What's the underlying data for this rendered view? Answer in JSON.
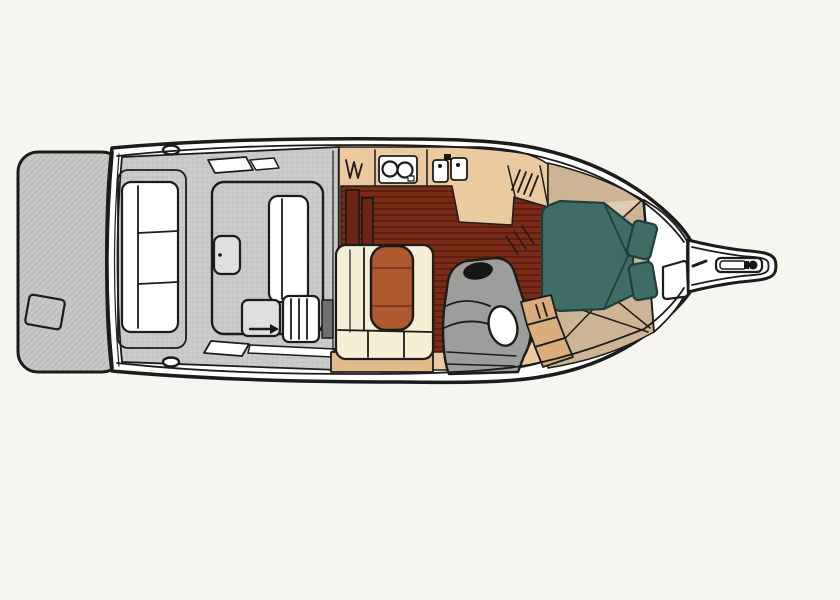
{
  "title": "Boat interior floor plan (overhead view)",
  "colors": {
    "page_bg": "#f7f5f0",
    "ink": "#1c1c1c",
    "hull_white": "#ffffff",
    "platform_gray": "#c7c7c5",
    "platform_line": "#b2b2b0",
    "cockpit_gray": "#cbcbc9",
    "cockpit_line": "#bdbdbb",
    "hatch_gray": "#dfdfdd",
    "vent_dark": "#6f6f6d",
    "floor_red": "#7c2b17",
    "floor_red_dark": "#5e1f10",
    "cabinet_red": "#6e2512",
    "counter_beige": "#eccaa0",
    "settee_cream": "#f5efd6",
    "settee_base_tan": "#e2ba8c",
    "table_rust": "#b0592f",
    "table_line": "#6b3118",
    "head_gray": "#9d9d9b",
    "fixture_black": "#161616",
    "toilet_white": "#ffffff",
    "steps_tan": "#d9ad7c",
    "fwd_tan": "#cdb495",
    "fwd_tan_light": "#e0ccb3",
    "berth_teal": "#406c66",
    "berth_teal_dark": "#213f3a"
  }
}
